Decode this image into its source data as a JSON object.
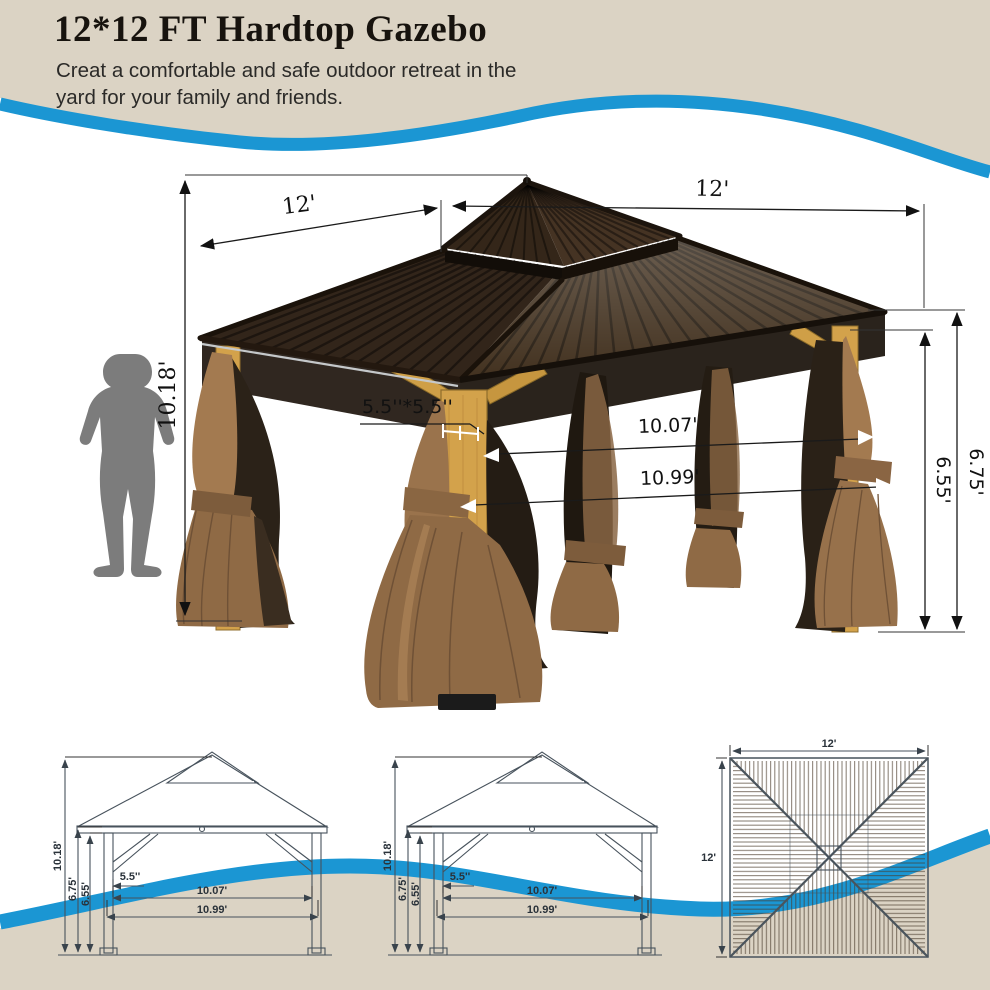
{
  "header": {
    "title": "12*12 FT Hardtop Gazebo",
    "subtitle": "Creat a comfortable and safe outdoor retreat in the yard for your family and friends."
  },
  "colors": {
    "accent_blue": "#1b96d3",
    "beige": "#dbd3c4",
    "roof_brown_left": "#32251a",
    "roof_brown_right": "#42311f",
    "wood_tan": "#d3a24b",
    "curtain_brown": "#97714b",
    "mesh_dark": "#261e15",
    "silhouette_gray": "#7c7c7c",
    "drawing_line": "#47525c"
  },
  "main_diagram": {
    "dim_total_height": "10.18'",
    "dim_roof_left": "12'",
    "dim_roof_right": "12'",
    "dim_post_section": "5.5''*5.5''",
    "dim_span_inner": "10.07'",
    "dim_span_outer": "10.99'",
    "dim_post_height_inner": "6.55'",
    "dim_post_height_outer": "6.75'"
  },
  "front_view": {
    "dim_total_height": "10.18'",
    "dim_post_height_outer": "6.75'",
    "dim_post_height_inner": "6.55'",
    "dim_post_width": "5.5''",
    "dim_span_inner": "10.07'",
    "dim_span_outer": "10.99'"
  },
  "side_view": {
    "dim_total_height": "10.18'",
    "dim_post_height_outer": "6.75'",
    "dim_post_height_inner": "6.55'",
    "dim_post_width": "5.5''",
    "dim_span_inner": "10.07'",
    "dim_span_outer": "10.99'"
  },
  "top_view": {
    "dim_width": "12'",
    "dim_depth": "12'"
  }
}
